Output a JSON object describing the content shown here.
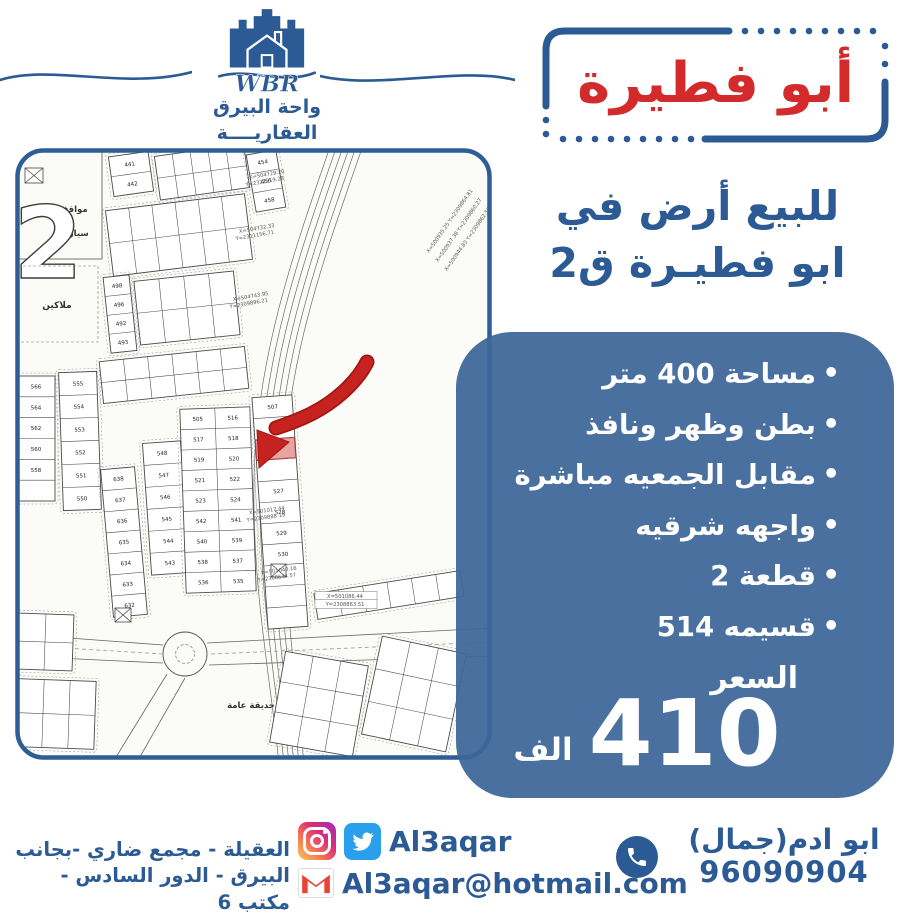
{
  "brand": {
    "name_en": "WBR",
    "name_ar_line1": "واحة البيرق",
    "name_ar_line2": "العقاريــــة"
  },
  "title": "أبو فطيرة",
  "heading": {
    "line1": "للبيع أرض في",
    "line2": "ابو فطيـرة ق2"
  },
  "features": [
    "مساحة 400 متر",
    "بطن وظهر ونافذ",
    "مقابل الجمعيه مباشرة",
    "واجهه شرقيه",
    "قطعة 2",
    "قسيمه 514"
  ],
  "price": {
    "label": "السعر",
    "value": "410",
    "unit": "الف"
  },
  "footer": {
    "address_line1": "العقيلة - مجمع ضاري -بجانب",
    "address_line2": "البيرق - الدور السادس - مكتب 6",
    "social_handle": "Al3aqar",
    "email": "Al3aqar@hotmail.com",
    "contact_name": "ابو ادم(جمال)",
    "phone": "96090904"
  },
  "map": {
    "block_number": "2",
    "labels": {
      "parking_1": "مواقف",
      "parking_2": "سيارات",
      "owners": "ملاكين",
      "garden": "حديقة عامة"
    },
    "highlighted_plot": "514",
    "plots": {
      "main_rows": [
        [
          "505",
          "516"
        ],
        [
          "517",
          "518"
        ],
        [
          "519",
          "520"
        ],
        [
          "521",
          "522"
        ],
        [
          "523",
          "524"
        ],
        [
          "542",
          "541"
        ],
        [
          "540",
          "539"
        ],
        [
          "538",
          "537"
        ],
        [
          "536",
          "535"
        ]
      ],
      "highlight_col": [
        "507",
        "513",
        "514",
        "",
        "527",
        "528",
        "529",
        "530",
        "",
        "",
        ""
      ],
      "strip_566": [
        "566",
        "564",
        "562",
        "560",
        "558",
        ""
      ],
      "strip_555": [
        "555",
        "554",
        "553",
        "552",
        "551",
        "550"
      ],
      "strip_638": [
        "638",
        "637",
        "636",
        "635",
        "634",
        "633",
        "632"
      ],
      "strip_548": [
        "548",
        "547",
        "546",
        "545",
        "544",
        "543"
      ],
      "strip_454": [
        "454",
        "456",
        "458"
      ],
      "strip_441": [
        "441",
        "442"
      ],
      "strip_498": [
        "498",
        "496",
        "492",
        "493"
      ]
    },
    "annotations": [
      {
        "t": "X=504729.20",
        "x": 252,
        "y": 28,
        "r": -10
      },
      {
        "t": "Y=2321219.28",
        "x": 250,
        "y": 35,
        "r": -10
      },
      {
        "t": "X=504732.33",
        "x": 242,
        "y": 82,
        "r": -10
      },
      {
        "t": "Y=2311156.71",
        "x": 240,
        "y": 89,
        "r": -10
      },
      {
        "t": "X=504743.95",
        "x": 236,
        "y": 150,
        "r": -10
      },
      {
        "t": "Y=2309896.21",
        "x": 234,
        "y": 157,
        "r": -10
      },
      {
        "t": "X=501017.44",
        "x": 252,
        "y": 364,
        "r": -8
      },
      {
        "t": "Y=2309888.19",
        "x": 251,
        "y": 371,
        "r": -8
      },
      {
        "t": "X=501040.16",
        "x": 264,
        "y": 424,
        "r": -8
      },
      {
        "t": "Y=2308644.57",
        "x": 262,
        "y": 431,
        "r": -8
      },
      {
        "t": "X=501086.44",
        "x": 330,
        "y": 450,
        "r": 0,
        "b": 1
      },
      {
        "t": "Y=2308863.51",
        "x": 330,
        "y": 458,
        "r": 0,
        "b": 1
      },
      {
        "t": "X=500935.25 Y=2309864.81",
        "x": 436,
        "y": 74,
        "r": -55
      },
      {
        "t": "X=500937.38 Y=2309860.27",
        "x": 445,
        "y": 83,
        "r": -55
      },
      {
        "t": "X=500944.83 Y=2309862.50",
        "x": 454,
        "y": 92,
        "r": -55
      }
    ]
  },
  "colors": {
    "brand_blue": "#2b5a94",
    "title_red": "#d32b2b",
    "panel_blue": "#4a73a3",
    "map_frame_blue": "#2d5f96",
    "arrow_red": "#c62320",
    "highlight_pink": "#e9a3a1",
    "twitter_blue": "#2aa0ed",
    "gmail_red": "#e94335"
  }
}
